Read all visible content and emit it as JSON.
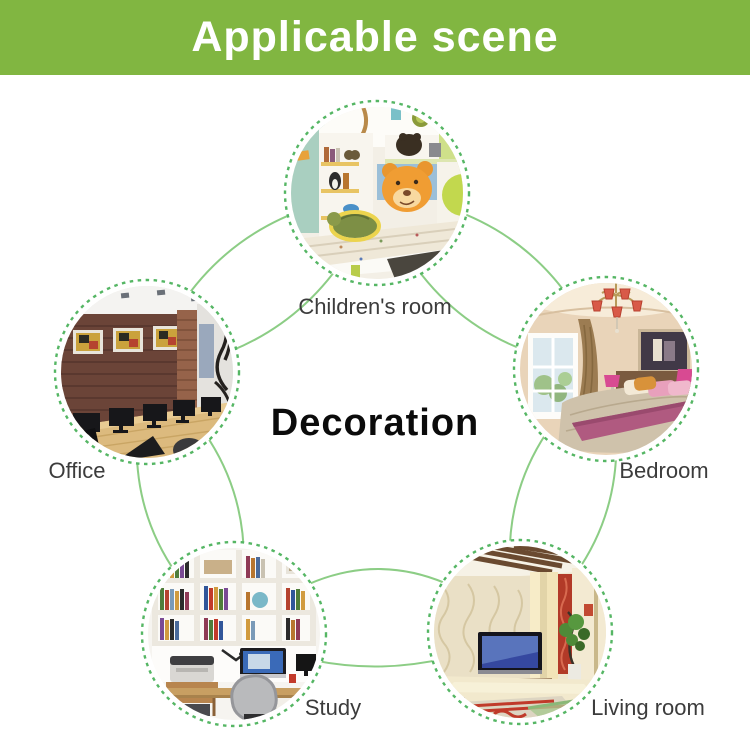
{
  "header": {
    "title": "Applicable scene",
    "bg_color": "#81b641",
    "text_color": "#ffffff"
  },
  "center_label": "Decoration",
  "colors": {
    "dotted_ring_green": "#55b664",
    "connector_line_green": "#8ccd85",
    "label_text": "#3c3c3c"
  },
  "scenes": [
    {
      "id": "children",
      "label": "Children's room",
      "position": "top"
    },
    {
      "id": "office",
      "label": "Office",
      "position": "left"
    },
    {
      "id": "bedroom",
      "label": "Bedroom",
      "position": "right"
    },
    {
      "id": "study",
      "label": "Study",
      "position": "bottom-left"
    },
    {
      "id": "living",
      "label": "Living room",
      "position": "bottom-right"
    }
  ]
}
